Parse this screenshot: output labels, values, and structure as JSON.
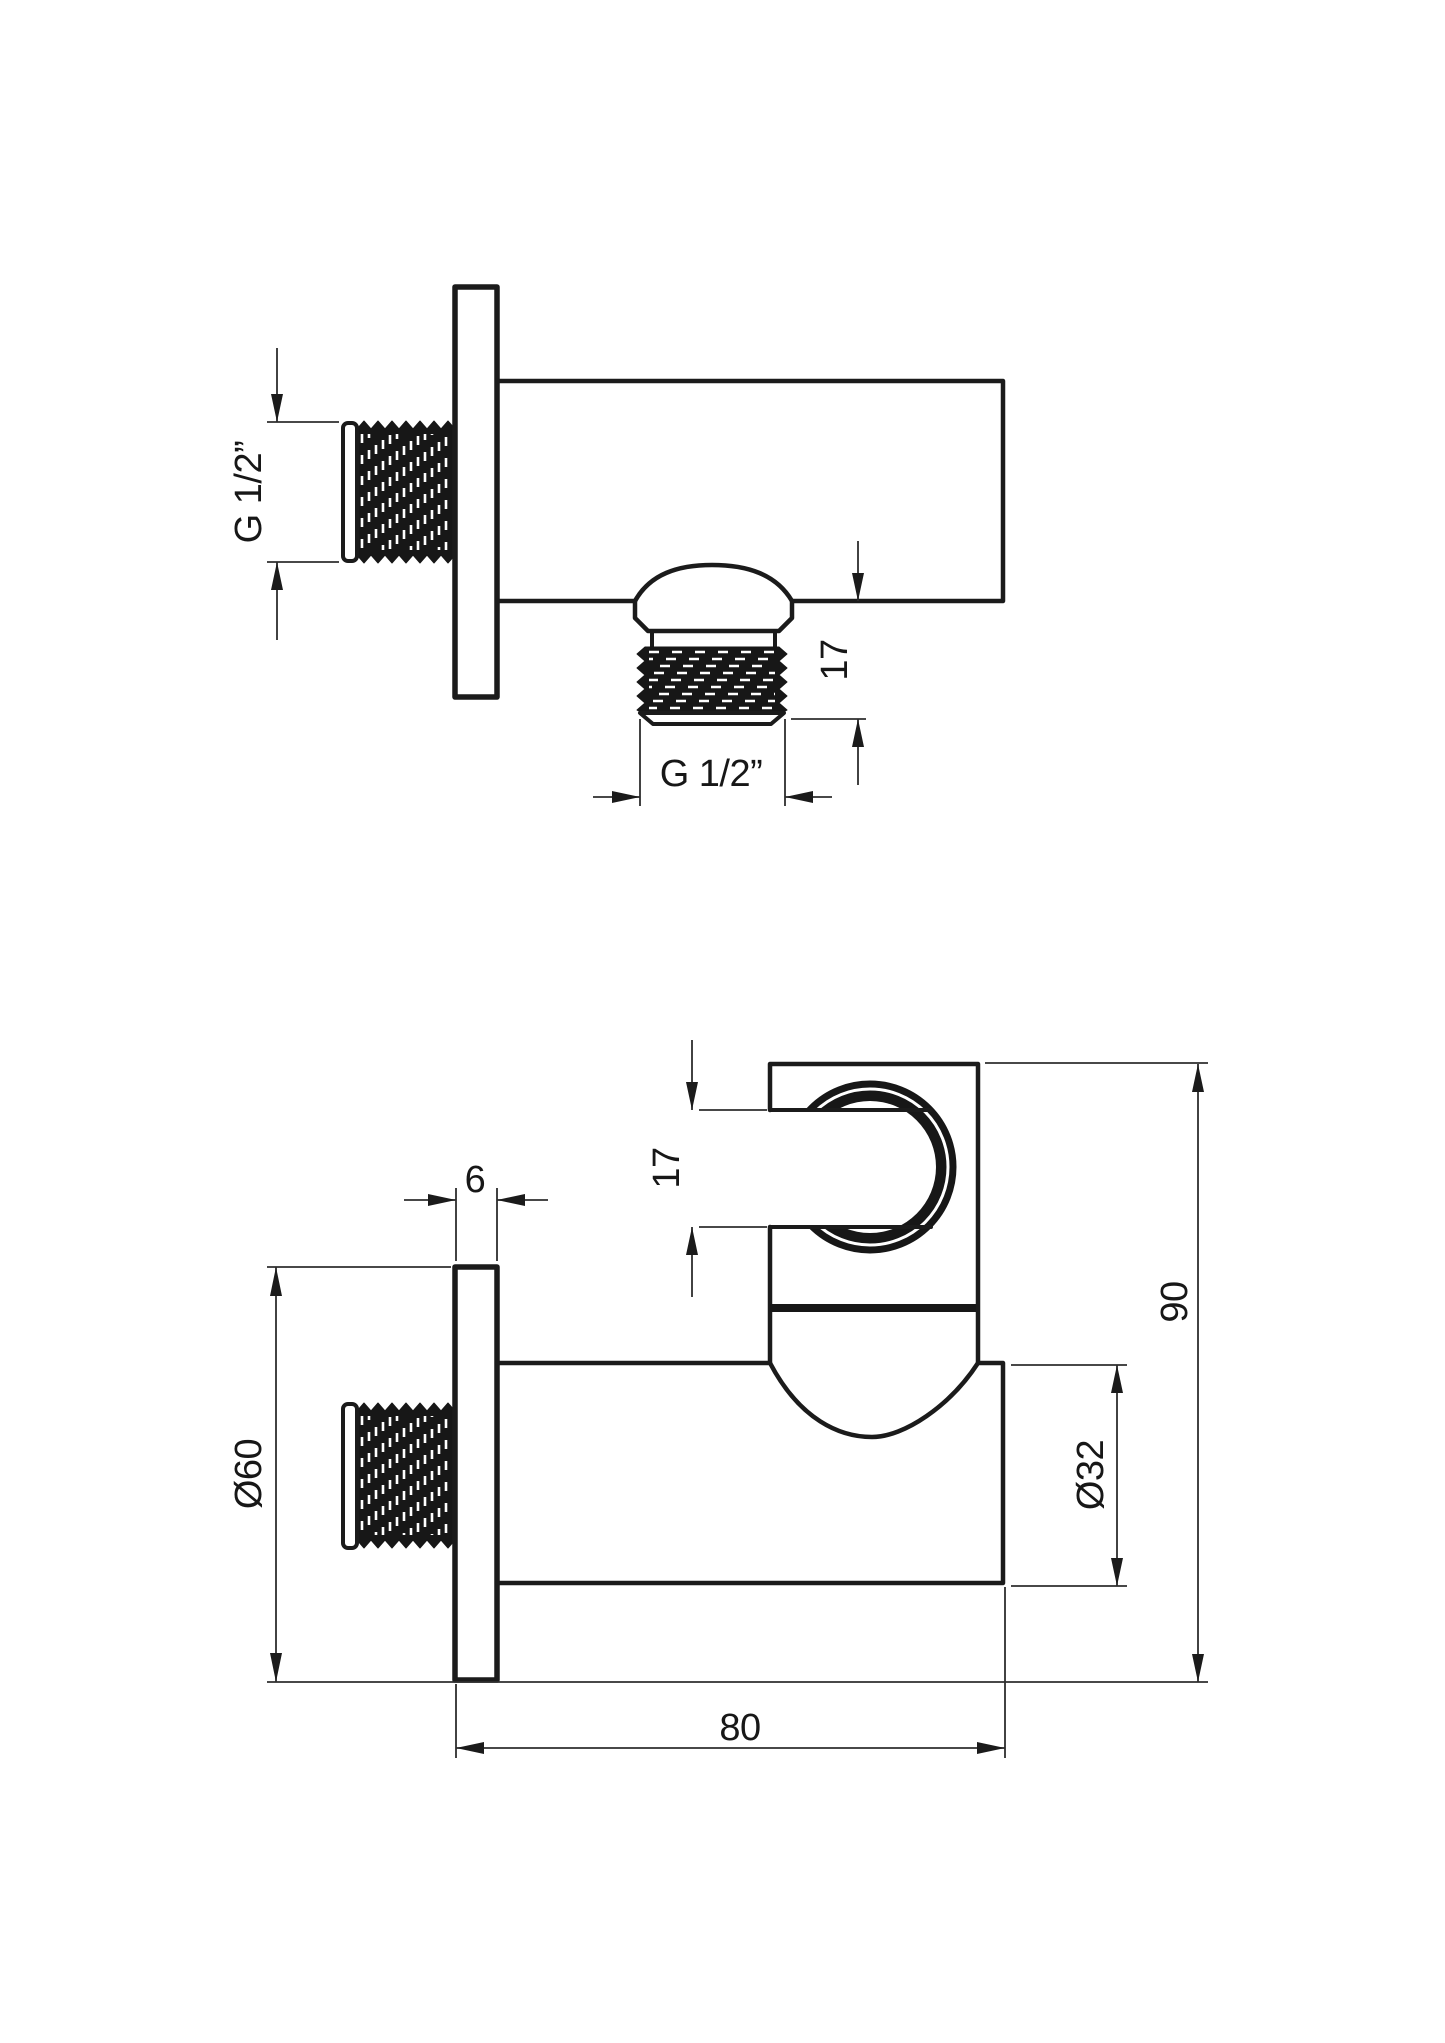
{
  "colors": {
    "background": "#ffffff",
    "line": "#1b1b1b"
  },
  "top_view": {
    "wall_thread_label": "G 1/2”",
    "outlet_thread_label": "G 1/2”",
    "outlet_length_label": "17"
  },
  "front_view": {
    "plate_thickness_label": "6",
    "holder_slot_label": "17",
    "plate_diameter_label": "Ø60",
    "body_diameter_label": "Ø32",
    "overall_height_label": "90",
    "overall_depth_label": "80"
  }
}
